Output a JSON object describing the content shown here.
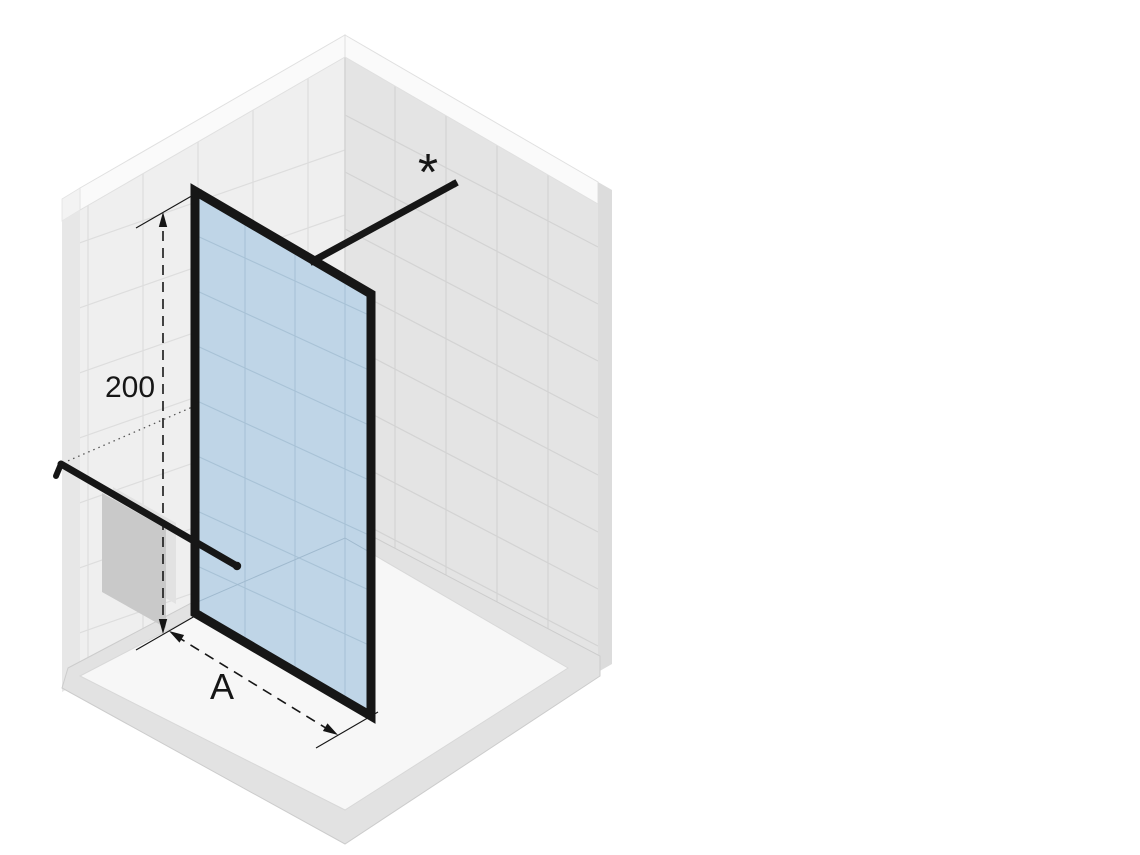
{
  "diagram": {
    "labels": {
      "height_dimension": "200",
      "width_dimension": "A",
      "footnote_marker": "*"
    },
    "colors": {
      "background": "#ffffff",
      "wall_left": "#efefef",
      "wall_left_tile_line": "#dddddd",
      "wall_right": "#e4e4e4",
      "wall_right_tile_line": "#d3d3d3",
      "wall_top_strip": "#fafafa",
      "wall_side_left": "#e7e7e7",
      "wall_side_right": "#dcdcdc",
      "floor_base": "#e2e2e2",
      "floor_tray": "#f7f7f7",
      "glass": "#bfd5e7",
      "glass_tile_line": "#a8c2d6",
      "frame": "#161616",
      "bar": "#161616",
      "towel_front": "#c9c9c9",
      "towel_back": "#e2e2e2",
      "dimension_line": "#161616",
      "hidden_dotted_line": "#555555"
    }
  }
}
